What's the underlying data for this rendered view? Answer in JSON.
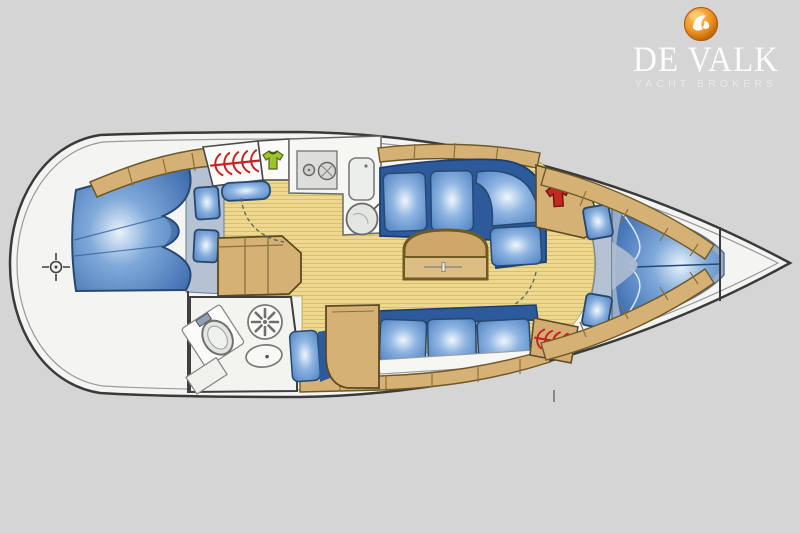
{
  "brand": {
    "title": "DE VALK",
    "subtitle": "YACHT BROKERS"
  },
  "logo": {
    "icon": "falcon-icon",
    "circle_color": "#ef9422"
  },
  "floorplan": {
    "type": "diagram",
    "subject": "sailing-yacht-interior-layout-top-view",
    "orientation": {
      "bow": "right",
      "stern": "left"
    },
    "colors": {
      "background": "#d5d5d5",
      "hull_fill": "#f4f4f2",
      "hull_outline": "#3a3a3a",
      "floor": "#ecd88e",
      "floor_stripe": "#d9bf6c",
      "wood": "#d6b176",
      "upholstery_blue": "#4a7ec0",
      "upholstery_dark_blue": "#2c5a9b",
      "pillow_blue": "#6f98cf",
      "heater_coil_red": "#c92020",
      "wardrobe_shirt_green": "#9cc42c",
      "wardrobe_shirt_red": "#c5281e"
    },
    "areas": [
      "aft-cabin-double-berth",
      "companionway-steps",
      "galley",
      "wet-head-with-toilet-sink-fan",
      "salon-l-settee",
      "salon-table",
      "salon-straight-settee",
      "nav-seat",
      "forward-cabin-v-berth",
      "anchor-locker-bow"
    ],
    "fixtures": [
      "stove-two-burners",
      "galley-sink",
      "round-basin",
      "fridge-top-lid",
      "heater-coil-aft",
      "heater-coil-forward",
      "wardrobe-green-shirt",
      "wardrobe-red-shirt",
      "toilet",
      "washbasin",
      "extractor-fan",
      "door-swing-aft",
      "door-swing-forward",
      "datum-crosshair"
    ]
  }
}
